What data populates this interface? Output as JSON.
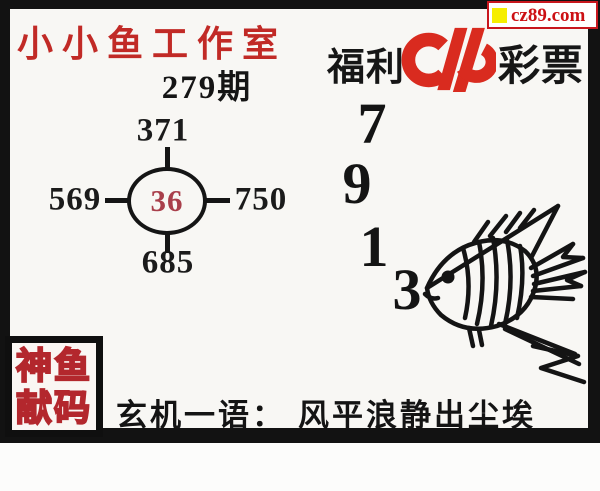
{
  "badge": {
    "url_text": "cz89.com",
    "square_icon_color": "#f6ee00",
    "text_color": "#cc1014"
  },
  "header": {
    "studio_title": "小小鱼工作室",
    "issue_label": "279期",
    "brand_left": "福利",
    "brand_right": "彩票",
    "brand_logo_name": "china-welfare-lottery-logo"
  },
  "diagram": {
    "top": "371",
    "left": "569",
    "right": "750",
    "bottom": "685",
    "center": "36",
    "center_color": "#a93f4b"
  },
  "big_digits": [
    "7",
    "9",
    "1",
    "3"
  ],
  "fish_illustration": "line-art-angelfish-facing-left",
  "stamp": {
    "row1": "神鱼",
    "row2": "献码",
    "stroke_color": "#b3272d"
  },
  "hint": {
    "label": "玄机一语：",
    "text": "风平浪静出尘埃"
  },
  "colors": {
    "title_red": "#c12a26",
    "logo_red": "#d92b1f",
    "ink": "#151515",
    "frame_black": "#121212",
    "paper": "#f8f7f4"
  }
}
